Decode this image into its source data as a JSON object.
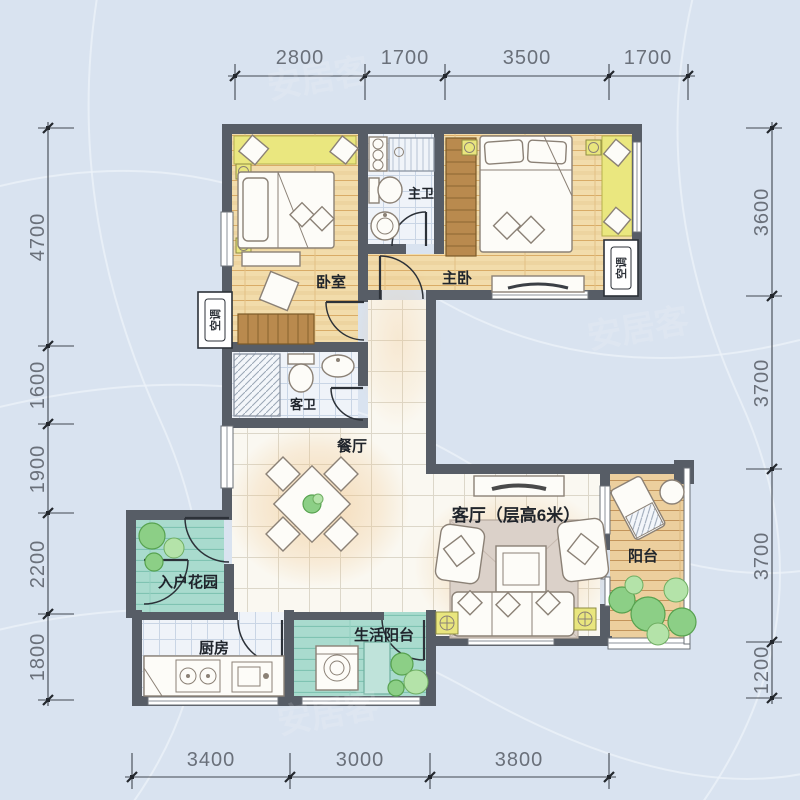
{
  "rooms": {
    "bedroom": {
      "label": "卧室"
    },
    "master_bedroom": {
      "label": "主卧"
    },
    "master_bath": {
      "label": "主卫"
    },
    "guest_bath": {
      "label": "客卫"
    },
    "dining": {
      "label": "餐厅"
    },
    "living": {
      "label": "客厅（层高6米）"
    },
    "balcony": {
      "label": "阳台"
    },
    "entry_garden": {
      "label": "入户花园"
    },
    "kitchen": {
      "label": "厨房"
    },
    "utility_balcony": {
      "label": "生活阳台"
    }
  },
  "equipment": {
    "ac_left": "空调",
    "ac_right": "空调"
  },
  "dimensions": {
    "top": [
      "2800",
      "1700",
      "3500",
      "1700"
    ],
    "left": [
      "4700",
      "1600",
      "1900",
      "2200",
      "1800"
    ],
    "right": [
      "3600",
      "3700",
      "3700",
      "1200"
    ],
    "bottom": [
      "3400",
      "3000",
      "3800"
    ]
  },
  "watermark": "安居客",
  "colors": {
    "background": "#d9e3f0",
    "wall": "#575d66",
    "bay_window": "#eae77f",
    "wood_floor": "#f2dcab",
    "teal_floor": "#a9dbce",
    "balcony_wood": "#eccf9e",
    "dimension_text": "#6a707a"
  }
}
